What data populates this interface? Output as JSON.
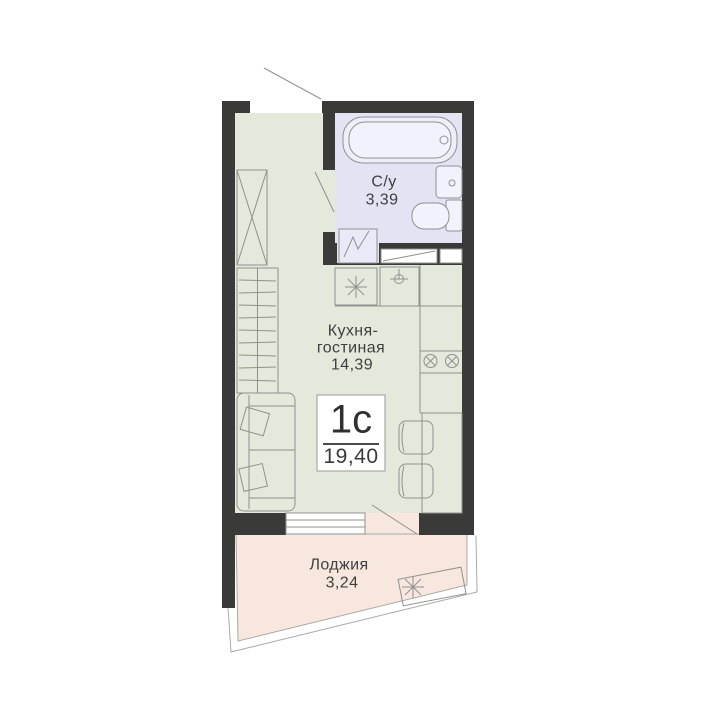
{
  "plan": {
    "unit": {
      "type": "1с",
      "area": "19,40"
    },
    "rooms": {
      "bathroom": {
        "name": "С/у",
        "area": "3,39"
      },
      "kitchen": {
        "name_line1": "Кухня-",
        "name_line2": "гостиная",
        "area": "14,39"
      },
      "loggia": {
        "name": "Лоджия",
        "area": "3,24"
      }
    },
    "colors": {
      "wall": "#3a3a38",
      "room_fill": "#e4e9db",
      "bathroom_fill": "#e3e3f3",
      "fixture_fill": "#eceef9",
      "loggia_fill": "#f8e7de",
      "line": "#90918f",
      "text": "#3f3f3f",
      "background": "#ffffff"
    },
    "icons": [
      "bathtub-icon",
      "bathroom-sink-icon",
      "toilet-icon",
      "shower-tray-icon",
      "stove-icon",
      "kitchen-sink-icon",
      "cooktop-burners-icon",
      "wardrobe-icon",
      "shelving-icon",
      "sofa-icon",
      "dining-table-icon",
      "chair-icon",
      "window-icon",
      "door-swing-icon",
      "drying-rack-icon"
    ]
  }
}
